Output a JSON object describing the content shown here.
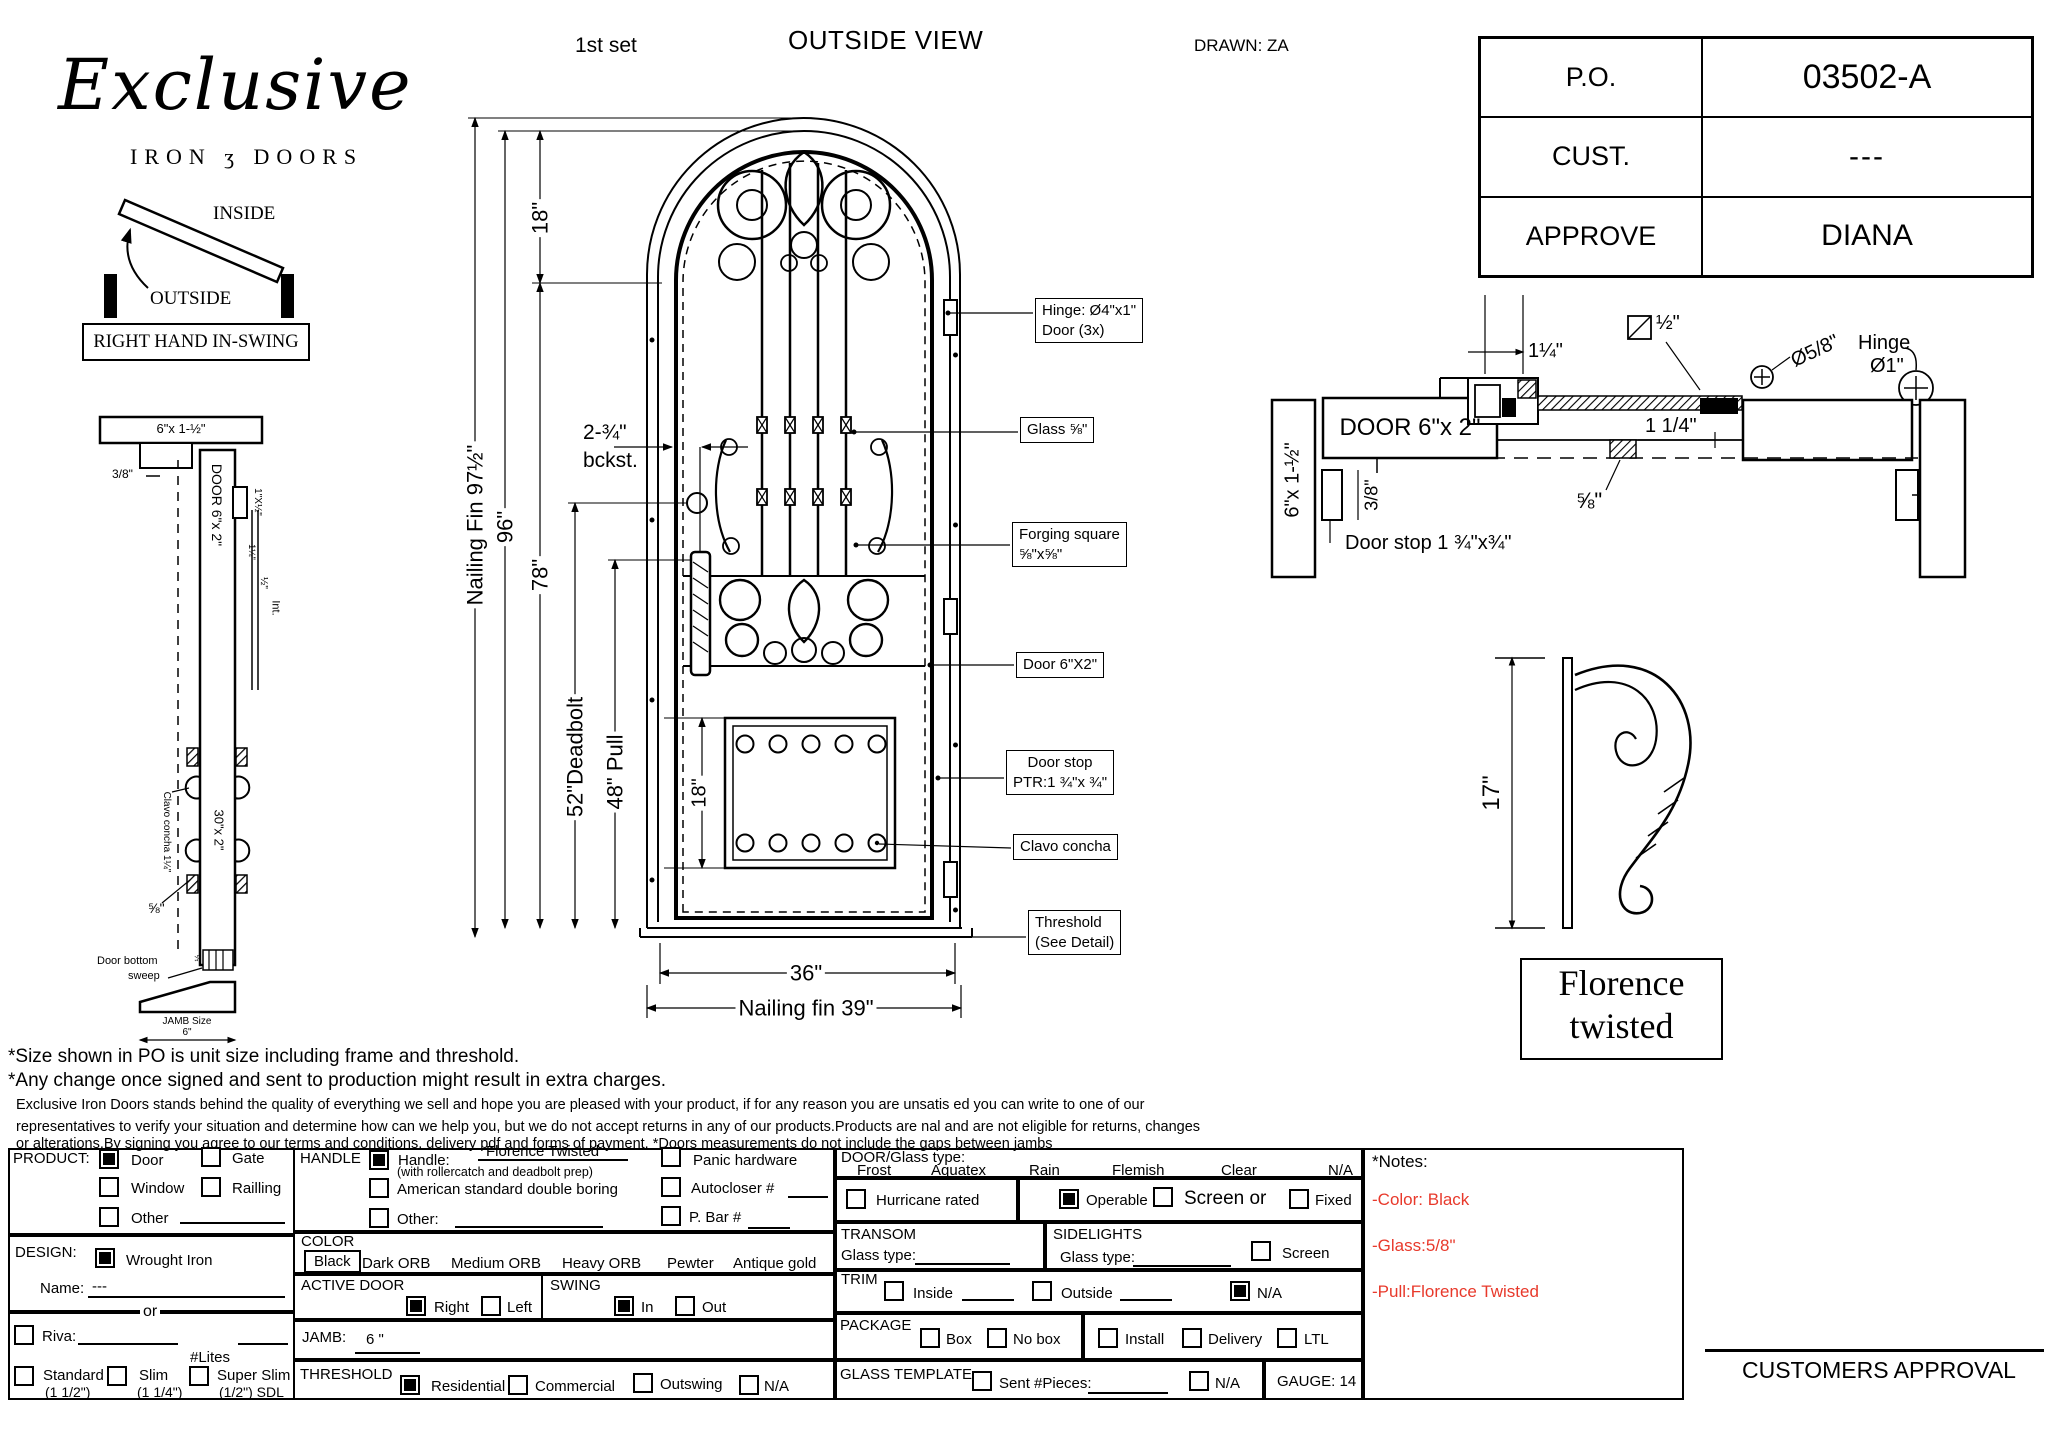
{
  "colors": {
    "note_red": "#e8392b",
    "ink": "#000000"
  },
  "header": {
    "set": "1st set",
    "title": "OUTSIDE VIEW",
    "drawn": "DRAWN: ZA"
  },
  "logo": {
    "script": "Exclusive",
    "line2": "IRON ʒ DOORS"
  },
  "swing_diagram": {
    "inside": "INSIDE",
    "outside": "OUTSIDE",
    "caption": "RIGHT HAND IN-SWING"
  },
  "po_table": {
    "rows": [
      {
        "label": "P.O.",
        "value": "03502-A"
      },
      {
        "label": "CUST.",
        "value": "---"
      },
      {
        "label": "APPROVE",
        "value": "DIANA"
      }
    ]
  },
  "left_section": {
    "head_size": "6\"x 1-½\"",
    "gap": "3/8\"",
    "door": "DOOR 6\"x 2\"",
    "glass_stop": "1\"X½\"",
    "d114": "1¼\"",
    "d12": "½\"",
    "int": "Int.",
    "clavo": "Clavo concha 1¼\"",
    "mid": "30\"x 2\"",
    "d58": "⅝\"",
    "sweep_l1": "Door bottom",
    "sweep_l2": "sweep",
    "half": "½",
    "jamb_l1": "JAMB Size",
    "jamb_l2": "6\""
  },
  "elevation": {
    "dim_fin_h": "Nailing Fin 97½\"",
    "dim_96": "96\"",
    "dim_78": "78\"",
    "dim_18": "18\"",
    "bckst_l1": "2-¾\"",
    "bckst_l2": "bckst.",
    "dim_deadbolt": "52\"Deadbolt",
    "dim_pull": "48\" Pull",
    "dim_panel": "18\"",
    "dim_36": "36\"",
    "dim_fin_w": "Nailing fin 39\"",
    "callouts": {
      "hinge_l1": "Hinge: Ø4\"x1\"",
      "hinge_l2": "Door (3x)",
      "glass": "Glass ⅝\"",
      "forge_l1": "Forging square",
      "forge_l2": "⅝\"x⅝\"",
      "door": "Door  6\"X2\"",
      "stop_l1": "Door stop",
      "stop_l2": "PTR:1 ¾\"x ¾\"",
      "clavo": "Clavo concha",
      "threshold_l1": "Threshold",
      "threshold_l2": "(See Detail)"
    }
  },
  "head_detail": {
    "d114": "1¼\"",
    "d12": "½\"",
    "d58_dia": "Ø5/8\"",
    "hinge_l1": "Hinge",
    "hinge_l2": "Ø1\"",
    "door": "DOOR 6\"x 2\"",
    "d114b": "1 1/4\"",
    "jamb": "6\"x 1-½\"",
    "d38": "3/8\"",
    "d58": "⅝\"",
    "stop": "Door stop 1 ¾\"x¾\""
  },
  "pull_detail": {
    "dim": "17\"",
    "name_l1": "Florence",
    "name_l2": "twisted"
  },
  "disclaimer": {
    "l1": "*Size shown in PO is unit size including frame and threshold.",
    "l2": "*Any change once signed and sent to production might result in extra charges.",
    "p1": "Exclusive Iron Doors stands behind the quality of everything we sell and hope you are pleased with your product, if for any reason you are unsatis   ed you can write to one of our",
    "p2": "representatives to verify your situation and determine how can we help you, but we do not accept returns in any of our products.Products are    nal and are not eligible for returns, changes",
    "p3": "or alterations.By signing you agree to our terms and conditions, delivery pdf and forms of payment. *Doors measurements do not include the gaps between jambs"
  },
  "form": {
    "product": {
      "label": "PRODUCT:",
      "door": "Door",
      "gate": "Gate",
      "window": "Window",
      "railing": "Railling",
      "other": "Other"
    },
    "design": {
      "label": "DESIGN:",
      "wrought": "Wrought Iron",
      "name": "Name:",
      "name_value": "---",
      "or": "or"
    },
    "riva": {
      "riva": "Riva:",
      "lites": "#Lites",
      "standard": "Standard",
      "standard_size": "(1 1/2\")",
      "slim": "Slim",
      "slim_size": "(1 1/4\")",
      "superslim": "Super Slim",
      "superslim_size": "(1/2\") SDL"
    },
    "handle": {
      "label": "HANDLE",
      "handle": "Handle:",
      "value": "Florence Twisted",
      "note": "(with rollercatch and deadbolt prep)",
      "american": "American standard double boring",
      "other": "Other:",
      "panic": "Panic hardware",
      "autocloser": "Autocloser #",
      "pbar": "P. Bar #"
    },
    "color": {
      "label": "COLOR",
      "black": "Black",
      "dark_orb": "Dark ORB",
      "medium_orb": "Medium ORB",
      "heavy_orb": "Heavy ORB",
      "pewter": "Pewter",
      "antique_gold": "Antique gold"
    },
    "active_door": {
      "label": "ACTIVE DOOR",
      "right": "Right",
      "left": "Left"
    },
    "swing": {
      "label": "SWING",
      "in": "In",
      "out": "Out"
    },
    "jamb": {
      "label": "JAMB:",
      "value": "6 \""
    },
    "threshold": {
      "label": "THRESHOLD",
      "residential": "Residential",
      "commercial": "Commercial",
      "outswing": "Outswing",
      "na": "N/A"
    },
    "glass": {
      "label": "DOOR/Glass type:",
      "frost": "Frost",
      "aquatex": "Aquatex",
      "rain": "Rain",
      "flemish": "Flemish",
      "clear": "Clear",
      "na": "N/A",
      "hurricane": "Hurricane rated",
      "operable": "Operable",
      "screen_or": "Screen or",
      "fixed": "Fixed"
    },
    "transom": {
      "label": "TRANSOM",
      "glass_type": "Glass type:"
    },
    "sidelights": {
      "label": "SIDELIGHTS",
      "glass_type": "Glass type:",
      "screen": "Screen"
    },
    "trim": {
      "label": "TRIM",
      "inside": "Inside",
      "outside": "Outside",
      "na": "N/A"
    },
    "package": {
      "label": "PACKAGE",
      "box": "Box",
      "no_box": "No box",
      "install": "Install",
      "delivery": "Delivery",
      "ltl": "LTL"
    },
    "glass_template": {
      "label": "GLASS TEMPLATE",
      "sent": "Sent #Pieces:",
      "na": "N/A",
      "gauge": "GAUGE: 14"
    },
    "notes": {
      "label": "*Notes:",
      "n1": "-Color: Black",
      "n2": "-Glass:5/8\"",
      "n3": "-Pull:Florence Twisted"
    },
    "checks": {
      "product_door": true,
      "product_gate": false,
      "product_window": false,
      "product_railing": false,
      "product_other": false,
      "design_wrought": true,
      "riva": false,
      "standard": false,
      "slim": false,
      "superslim": false,
      "handle": true,
      "american": false,
      "handle_other": false,
      "panic": false,
      "autocloser": false,
      "pbar": false,
      "active_right": true,
      "active_left": false,
      "swing_in": true,
      "swing_out": false,
      "threshold_residential": true,
      "threshold_commercial": false,
      "threshold_outswing": false,
      "threshold_na": false,
      "hurricane": false,
      "operable": true,
      "screen": false,
      "fixed": false,
      "sidelight_screen": false,
      "trim_inside": false,
      "trim_outside": false,
      "trim_na": true,
      "pkg_box": false,
      "pkg_nobox": false,
      "pkg_install": false,
      "pkg_delivery": false,
      "pkg_ltl": false,
      "template_sent": false,
      "template_na": false
    }
  },
  "approval": "CUSTOMERS APPROVAL"
}
